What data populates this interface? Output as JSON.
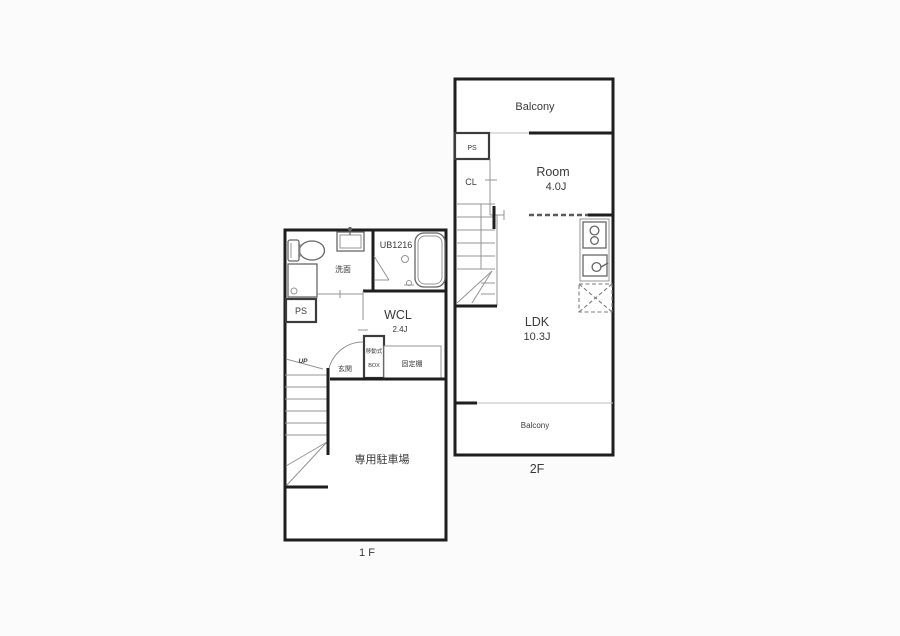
{
  "page": {
    "background": "#fbfbfb"
  },
  "colors": {
    "wall": "#1e1e1e",
    "thin_line": "#949494",
    "text": "#3a3a3a",
    "room_fill": "#ffffff"
  },
  "floor2": {
    "floor_label": "2F",
    "balcony_top_label": "Balcony",
    "ps_label": "PS",
    "cl_label": "CL",
    "room_label": "Room",
    "room_size": "4.0J",
    "ldk_label": "LDK",
    "ldk_size": "10.3J",
    "balcony_bottom_label": "Balcony"
  },
  "floor1": {
    "floor_label": "1 F",
    "washroom_label": "洗面",
    "bath_label": "UB1216",
    "ps_label": "PS",
    "wcl_label": "WCL",
    "wcl_size": "2.4J",
    "up_label": "UP",
    "entrance_label": "玄関",
    "movable_box_label_1": "移動式",
    "movable_box_label_2": "BOX",
    "fixed_shelf_label": "固定棚",
    "parking_label": "専用駐車場"
  }
}
